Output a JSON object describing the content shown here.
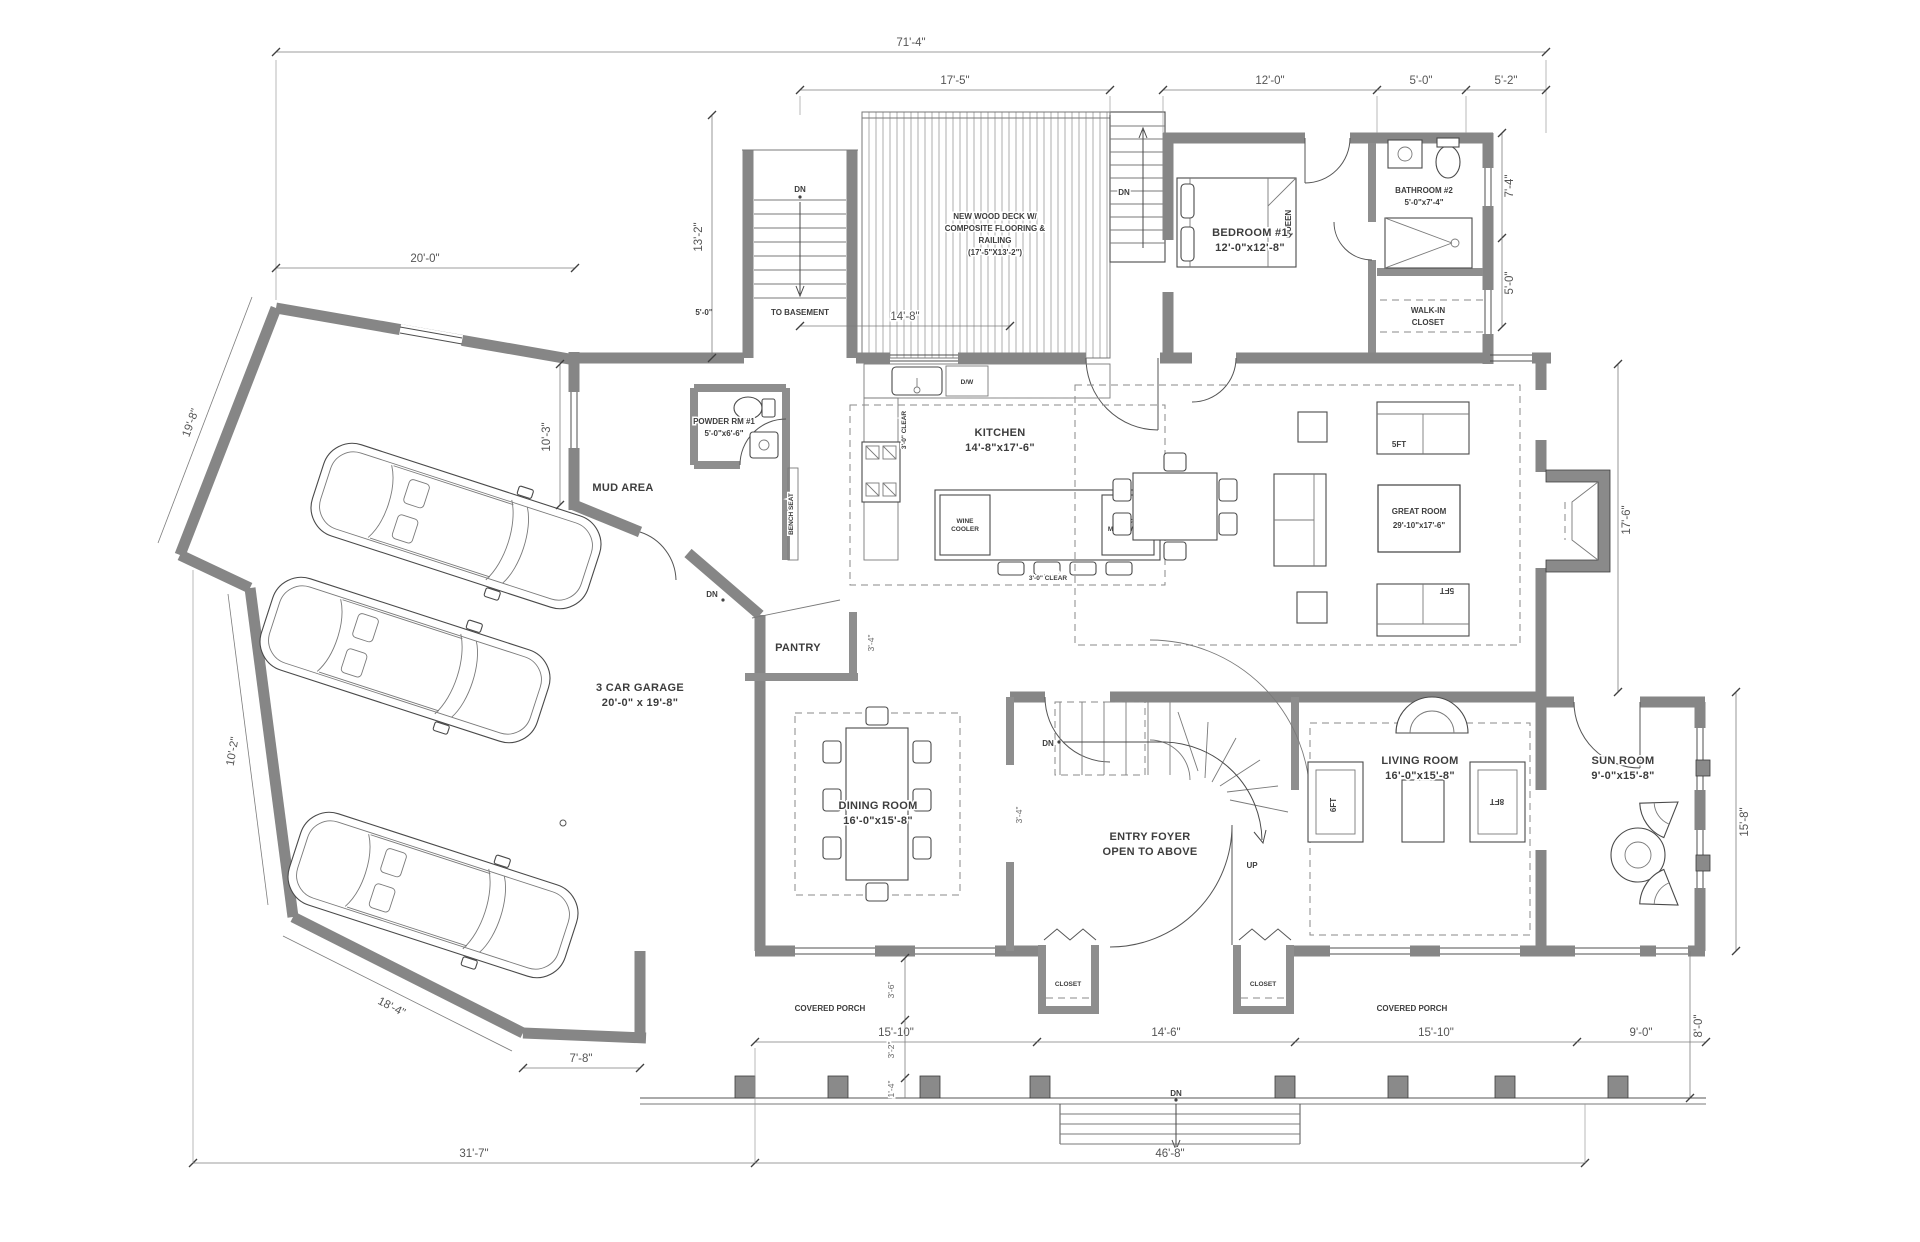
{
  "rooms": {
    "deck": {
      "l1": "NEW WOOD DECK W/",
      "l2": "COMPOSITE FLOORING &",
      "l3": "RAILING",
      "l4": "(17'-5\"X13'-2\")"
    },
    "bedroom1": {
      "name": "BEDROOM #1",
      "size": "12'-0\"x12'-8\""
    },
    "bathroom2": {
      "name": "BATHROOM #2",
      "size": "5'-0\"x7'-4\""
    },
    "walkin": {
      "l1": "WALK-IN",
      "l2": "CLOSET"
    },
    "kitchen": {
      "name": "KITCHEN",
      "size": "14'-8\"x17'-6\""
    },
    "great_room": {
      "name": "GREAT ROOM",
      "size": "29'-10\"x17'-6\""
    },
    "powder": {
      "name": "POWDER RM #1",
      "size": "5'-0\"x6'-6\""
    },
    "mud": {
      "name": "MUD AREA"
    },
    "pantry": {
      "name": "PANTRY"
    },
    "garage": {
      "name": "3 CAR GARAGE",
      "size": "20'-0\" x 19'-8\""
    },
    "dining": {
      "name": "DINING ROOM",
      "size": "16'-0\"x15'-8\""
    },
    "foyer": {
      "l1": "ENTRY FOYER",
      "l2": "OPEN TO ABOVE"
    },
    "living": {
      "name": "LIVING ROOM",
      "size": "16'-0\"x15'-8\""
    },
    "sun": {
      "name": "SUN ROOM",
      "size": "9'-0\"x15'-8\""
    },
    "porch_left": "COVERED PORCH",
    "porch_right": "COVERED PORCH",
    "closet_left": "CLOSET",
    "closet_right": "CLOSET"
  },
  "annotations": {
    "dn": "DN",
    "up": "UP",
    "to_basement": "TO BASEMENT",
    "queen": "QUEEN",
    "bench_seat": "BENCH SEAT",
    "wine_l1": "WINE",
    "wine_l2": "COOLER",
    "micro_l1": "U.C.",
    "micro_l2": "MICROWAVE",
    "dw": "D/W",
    "sofa_5ft": "5FT",
    "sofa_5ft_b": "5FT",
    "sofa_6ft": "6FT",
    "sofa_8ft": "8FT",
    "clear_v": "3'-0\" CLEAR",
    "clear_h": "3'-0\" CLEAR"
  },
  "dimensions": {
    "overall_top": "71'-4\"",
    "deck_w": "17'-5\"",
    "bedroom_w": "12'-0\"",
    "bath_w": "5'-0\"",
    "offset_r": "5'-2\"",
    "deck_h": "13'-2\"",
    "garage_top": "20'-0\"",
    "stair_w": "5'-0\"",
    "deck_lower": "14'-8\"",
    "bath_h": "7'-4\"",
    "closet_h": "5'-0\"",
    "great_h": "17'-6\"",
    "mud_h": "10'-3\"",
    "garage_side": "19'-8\"",
    "garage_lower": "10'-2\"",
    "garage_door": "18'-4\"",
    "corner": "7'-8\"",
    "porch_l": "15'-10\"",
    "front_c": "14'-6\"",
    "porch_r": "15'-10\"",
    "porch_ext": "9'-0\"",
    "sun_h": "15'-8\"",
    "porch_d": "8'-0\"",
    "d36": "3'-6\"",
    "d32": "3'-2\"",
    "d14": "1'-4\"",
    "d34": "3'-4\"",
    "d34b": "3'-4\"",
    "bottom_l": "31'-7\"",
    "bottom_r": "46'-8\""
  }
}
